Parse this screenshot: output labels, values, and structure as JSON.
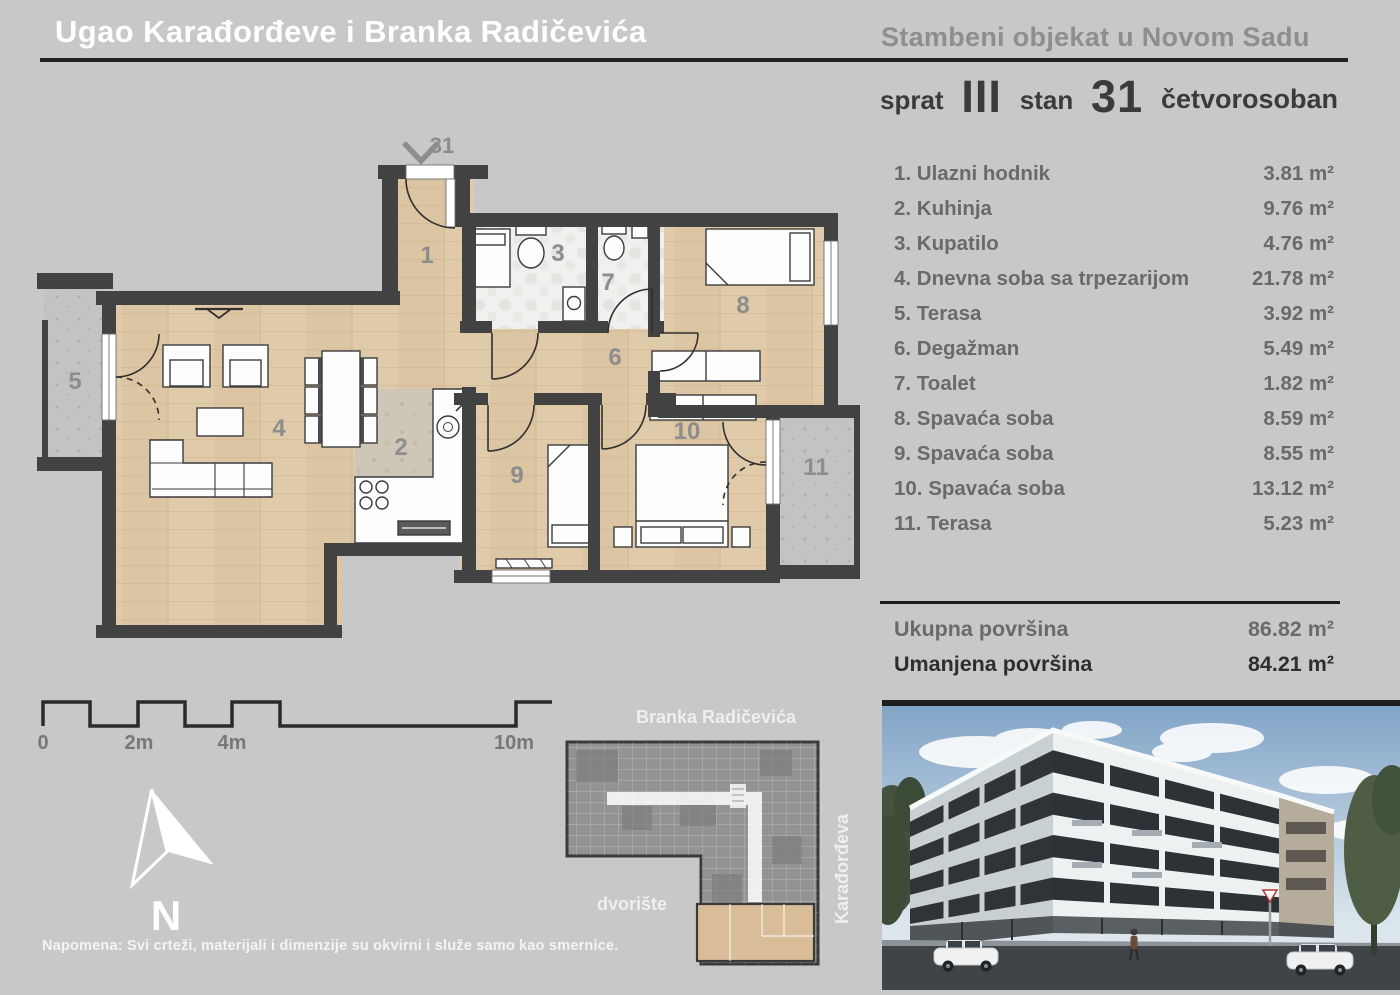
{
  "header": {
    "title": "Ugao Karađorđeve i Branka Radičevića",
    "subtitle": "Stambeni objekat u Novom Sadu",
    "floor_label": "sprat",
    "floor_value": "III",
    "apartment_label": "stan",
    "apartment_value": "31",
    "apartment_type": "četvorosoban"
  },
  "room_list": {
    "rooms": [
      {
        "label": "1. Ulazni hodnik",
        "area": "3.81 m²"
      },
      {
        "label": "2. Kuhinja",
        "area": "9.76 m²"
      },
      {
        "label": "3. Kupatilo",
        "area": "4.76 m²"
      },
      {
        "label": "4. Dnevna soba sa trpezarijom",
        "area": "21.78 m²"
      },
      {
        "label": "5. Terasa",
        "area": "3.92 m²"
      },
      {
        "label": "6. Degažman",
        "area": "5.49 m²"
      },
      {
        "label": "7. Toalet",
        "area": "1.82 m²"
      },
      {
        "label": "8. Spavaća soba",
        "area": "8.59 m²"
      },
      {
        "label": "9. Spavaća soba",
        "area": "8.55 m²"
      },
      {
        "label": "10. Spavaća soba",
        "area": "13.12 m²"
      },
      {
        "label": "11. Terasa",
        "area": "5.23 m²"
      }
    ],
    "totals": [
      {
        "label": "Ukupna površina",
        "value": "86.82 m²"
      },
      {
        "label": "Umanjena površina",
        "value": "84.21 m²"
      }
    ]
  },
  "floor_plan": {
    "entrance_unit": "31",
    "room_numbers": [
      "1",
      "2",
      "3",
      "4",
      "5",
      "6",
      "7",
      "8",
      "9",
      "10",
      "11"
    ]
  },
  "scale_bar": {
    "ticks": [
      "0",
      "2m",
      "4m",
      "10m"
    ]
  },
  "compass": {
    "label": "N"
  },
  "note": "Napomena: Svi crteži, materijali i dimenzije su okvirni i služe samo kao smernice.",
  "site_plan": {
    "street_top": "Branka Radičevića",
    "street_right": "Karađorđeva",
    "courtyard_label": "dvorište"
  },
  "colors": {
    "background": "#c8c8c8",
    "wall": "#424242",
    "wood_floor": "#dfcaa9",
    "tile_floor": "#f1f0ee",
    "terrace_floor": "#c3c3c3",
    "kitchen_floor": "#cec6b7",
    "rule_dark": "#232323",
    "text_white": "#ffffff",
    "text_gray": "#6a6a6a",
    "text_dark": "#2e2e2e",
    "room_number_gray": "#8d8d8d",
    "highlighted_apartment": "#d9bd99"
  }
}
